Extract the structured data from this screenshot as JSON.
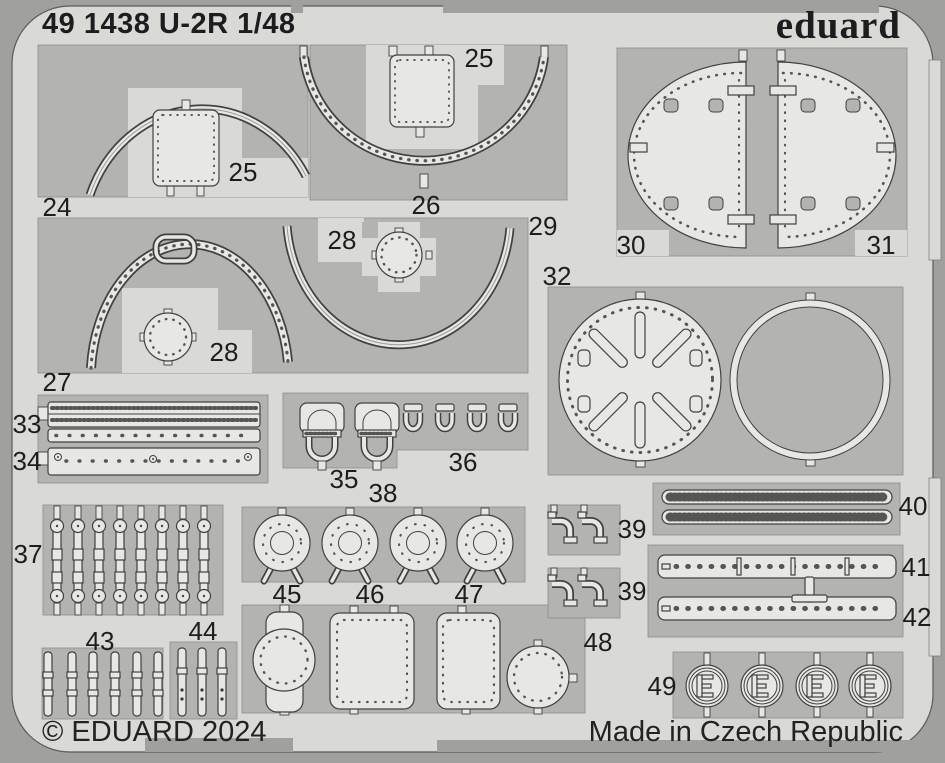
{
  "header": {
    "title": "49 1438 U-2R 1/48",
    "brand": "eduard"
  },
  "footer": {
    "copyright": "© EDUARD 2024",
    "origin": "Made in Czech Republic"
  },
  "colors": {
    "frame": "#a0a09e",
    "sheet": "#d9d9d6",
    "panel": "#b3b3b0",
    "part": "#e7e7e4",
    "outline": "#414141",
    "text": "#1d1d1f"
  },
  "fret": {
    "labels": [
      {
        "part": "24",
        "x": 57,
        "y": 207
      },
      {
        "part": "25",
        "x": 243,
        "y": 172
      },
      {
        "part": "25",
        "x": 479,
        "y": 58
      },
      {
        "part": "26",
        "x": 426,
        "y": 205
      },
      {
        "part": "27",
        "x": 57,
        "y": 382
      },
      {
        "part": "28",
        "x": 342,
        "y": 240
      },
      {
        "part": "28",
        "x": 224,
        "y": 352
      },
      {
        "part": "29",
        "x": 543,
        "y": 226
      },
      {
        "part": "30",
        "x": 631,
        "y": 245
      },
      {
        "part": "31",
        "x": 881,
        "y": 245
      },
      {
        "part": "32",
        "x": 557,
        "y": 276
      },
      {
        "part": "33",
        "x": 27,
        "y": 424
      },
      {
        "part": "34",
        "x": 27,
        "y": 461
      },
      {
        "part": "35",
        "x": 344,
        "y": 479
      },
      {
        "part": "36",
        "x": 463,
        "y": 462
      },
      {
        "part": "37",
        "x": 28,
        "y": 554
      },
      {
        "part": "38",
        "x": 383,
        "y": 493
      },
      {
        "part": "39",
        "x": 632,
        "y": 529
      },
      {
        "part": "39",
        "x": 632,
        "y": 591
      },
      {
        "part": "40",
        "x": 913,
        "y": 506
      },
      {
        "part": "41",
        "x": 916,
        "y": 567
      },
      {
        "part": "42",
        "x": 917,
        "y": 617
      },
      {
        "part": "43",
        "x": 100,
        "y": 641
      },
      {
        "part": "44",
        "x": 203,
        "y": 631
      },
      {
        "part": "45",
        "x": 287,
        "y": 594
      },
      {
        "part": "46",
        "x": 370,
        "y": 594
      },
      {
        "part": "47",
        "x": 469,
        "y": 594
      },
      {
        "part": "48",
        "x": 598,
        "y": 642
      },
      {
        "part": "49",
        "x": 662,
        "y": 686
      }
    ]
  }
}
